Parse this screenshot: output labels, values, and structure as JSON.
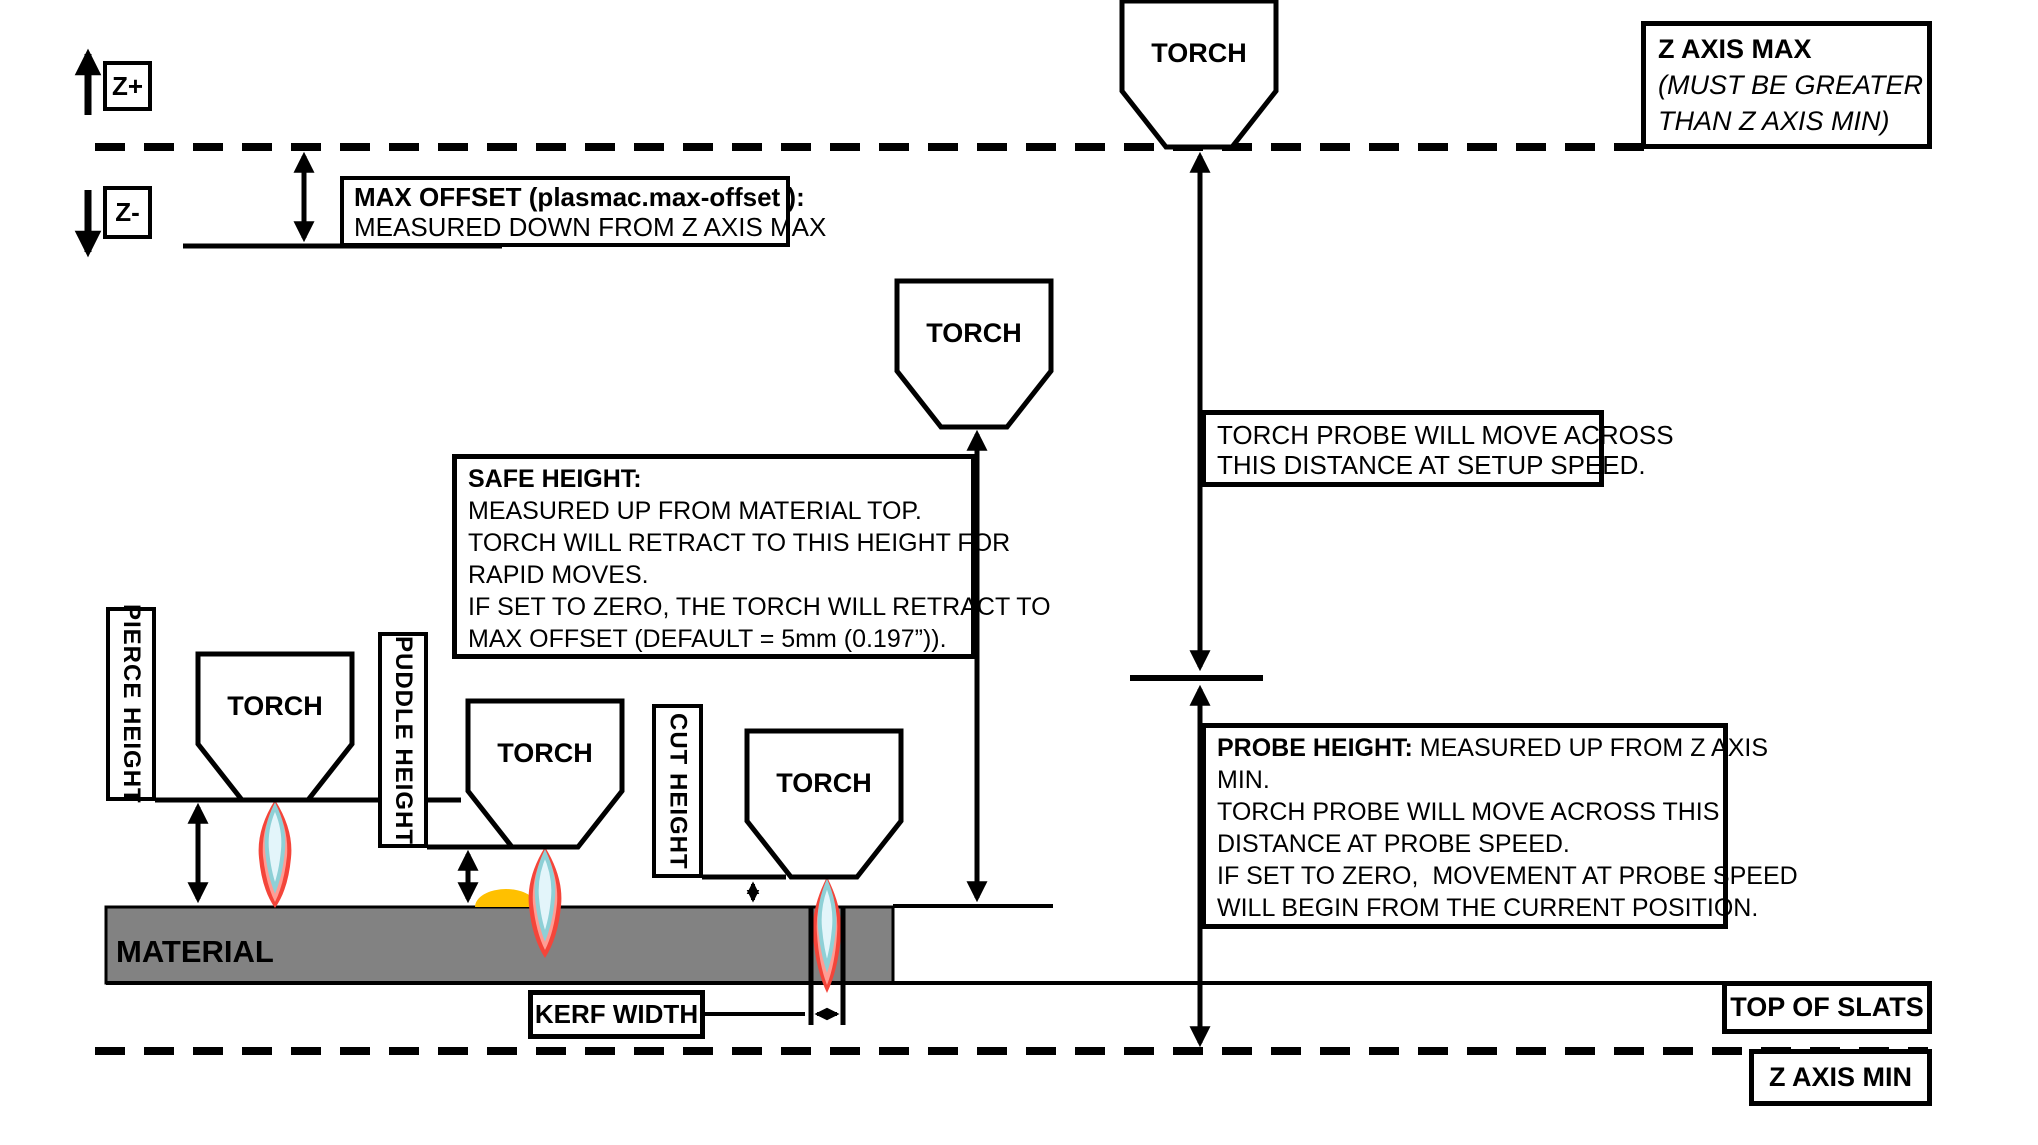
{
  "axis": {
    "z_plus": "Z+",
    "z_minus": "Z-"
  },
  "torch_label": "TORCH",
  "boxes": {
    "z_axis_max": {
      "title": "Z AXIS MAX",
      "line2": "(MUST BE GREATER",
      "line3": "THAN Z AXIS MIN)"
    },
    "max_offset": {
      "title": "MAX OFFSET (plasmac.max-offset ):",
      "line2": "MEASURED DOWN FROM Z AXIS MAX"
    },
    "safe_height": {
      "title": "SAFE HEIGHT:",
      "lines": [
        "MEASURED UP FROM MATERIAL TOP.",
        "TORCH WILL RETRACT TO THIS HEIGHT FOR",
        "RAPID MOVES.",
        "IF SET TO ZERO, THE TORCH WILL RETRACT TO",
        "MAX OFFSET (DEFAULT = 5mm (0.197”))."
      ]
    },
    "torch_probe": {
      "line1": "TORCH PROBE WILL MOVE ACROSS",
      "line2": "THIS DISTANCE AT SETUP SPEED."
    },
    "probe_height": {
      "title": "PROBE HEIGHT:",
      "title_rest": " MEASURED UP FROM Z AXIS",
      "lines": [
        "MIN.",
        "TORCH PROBE WILL MOVE ACROSS THIS",
        "DISTANCE AT PROBE SPEED.",
        "IF SET TO ZERO,  MOVEMENT AT PROBE SPEED",
        "WILL BEGIN FROM THE CURRENT POSITION."
      ]
    },
    "kerf_width": "KERF WIDTH",
    "top_of_slats": "TOP OF SLATS",
    "z_axis_min": "Z AXIS MIN"
  },
  "height_labels": {
    "pierce": "PIERCE HEIGHT",
    "puddle": "PUDDLE HEIGHT",
    "cut": "CUT HEIGHT"
  },
  "material_label": "MATERIAL",
  "colors": {
    "material": "#828282",
    "flame_outer": "#f4453a",
    "flame_mid": "#ff9d94",
    "flame_core": "#e3f5fa",
    "flame_core_edge": "#8ed0d6",
    "puddle": "#ffc000",
    "ink": "#000000"
  }
}
